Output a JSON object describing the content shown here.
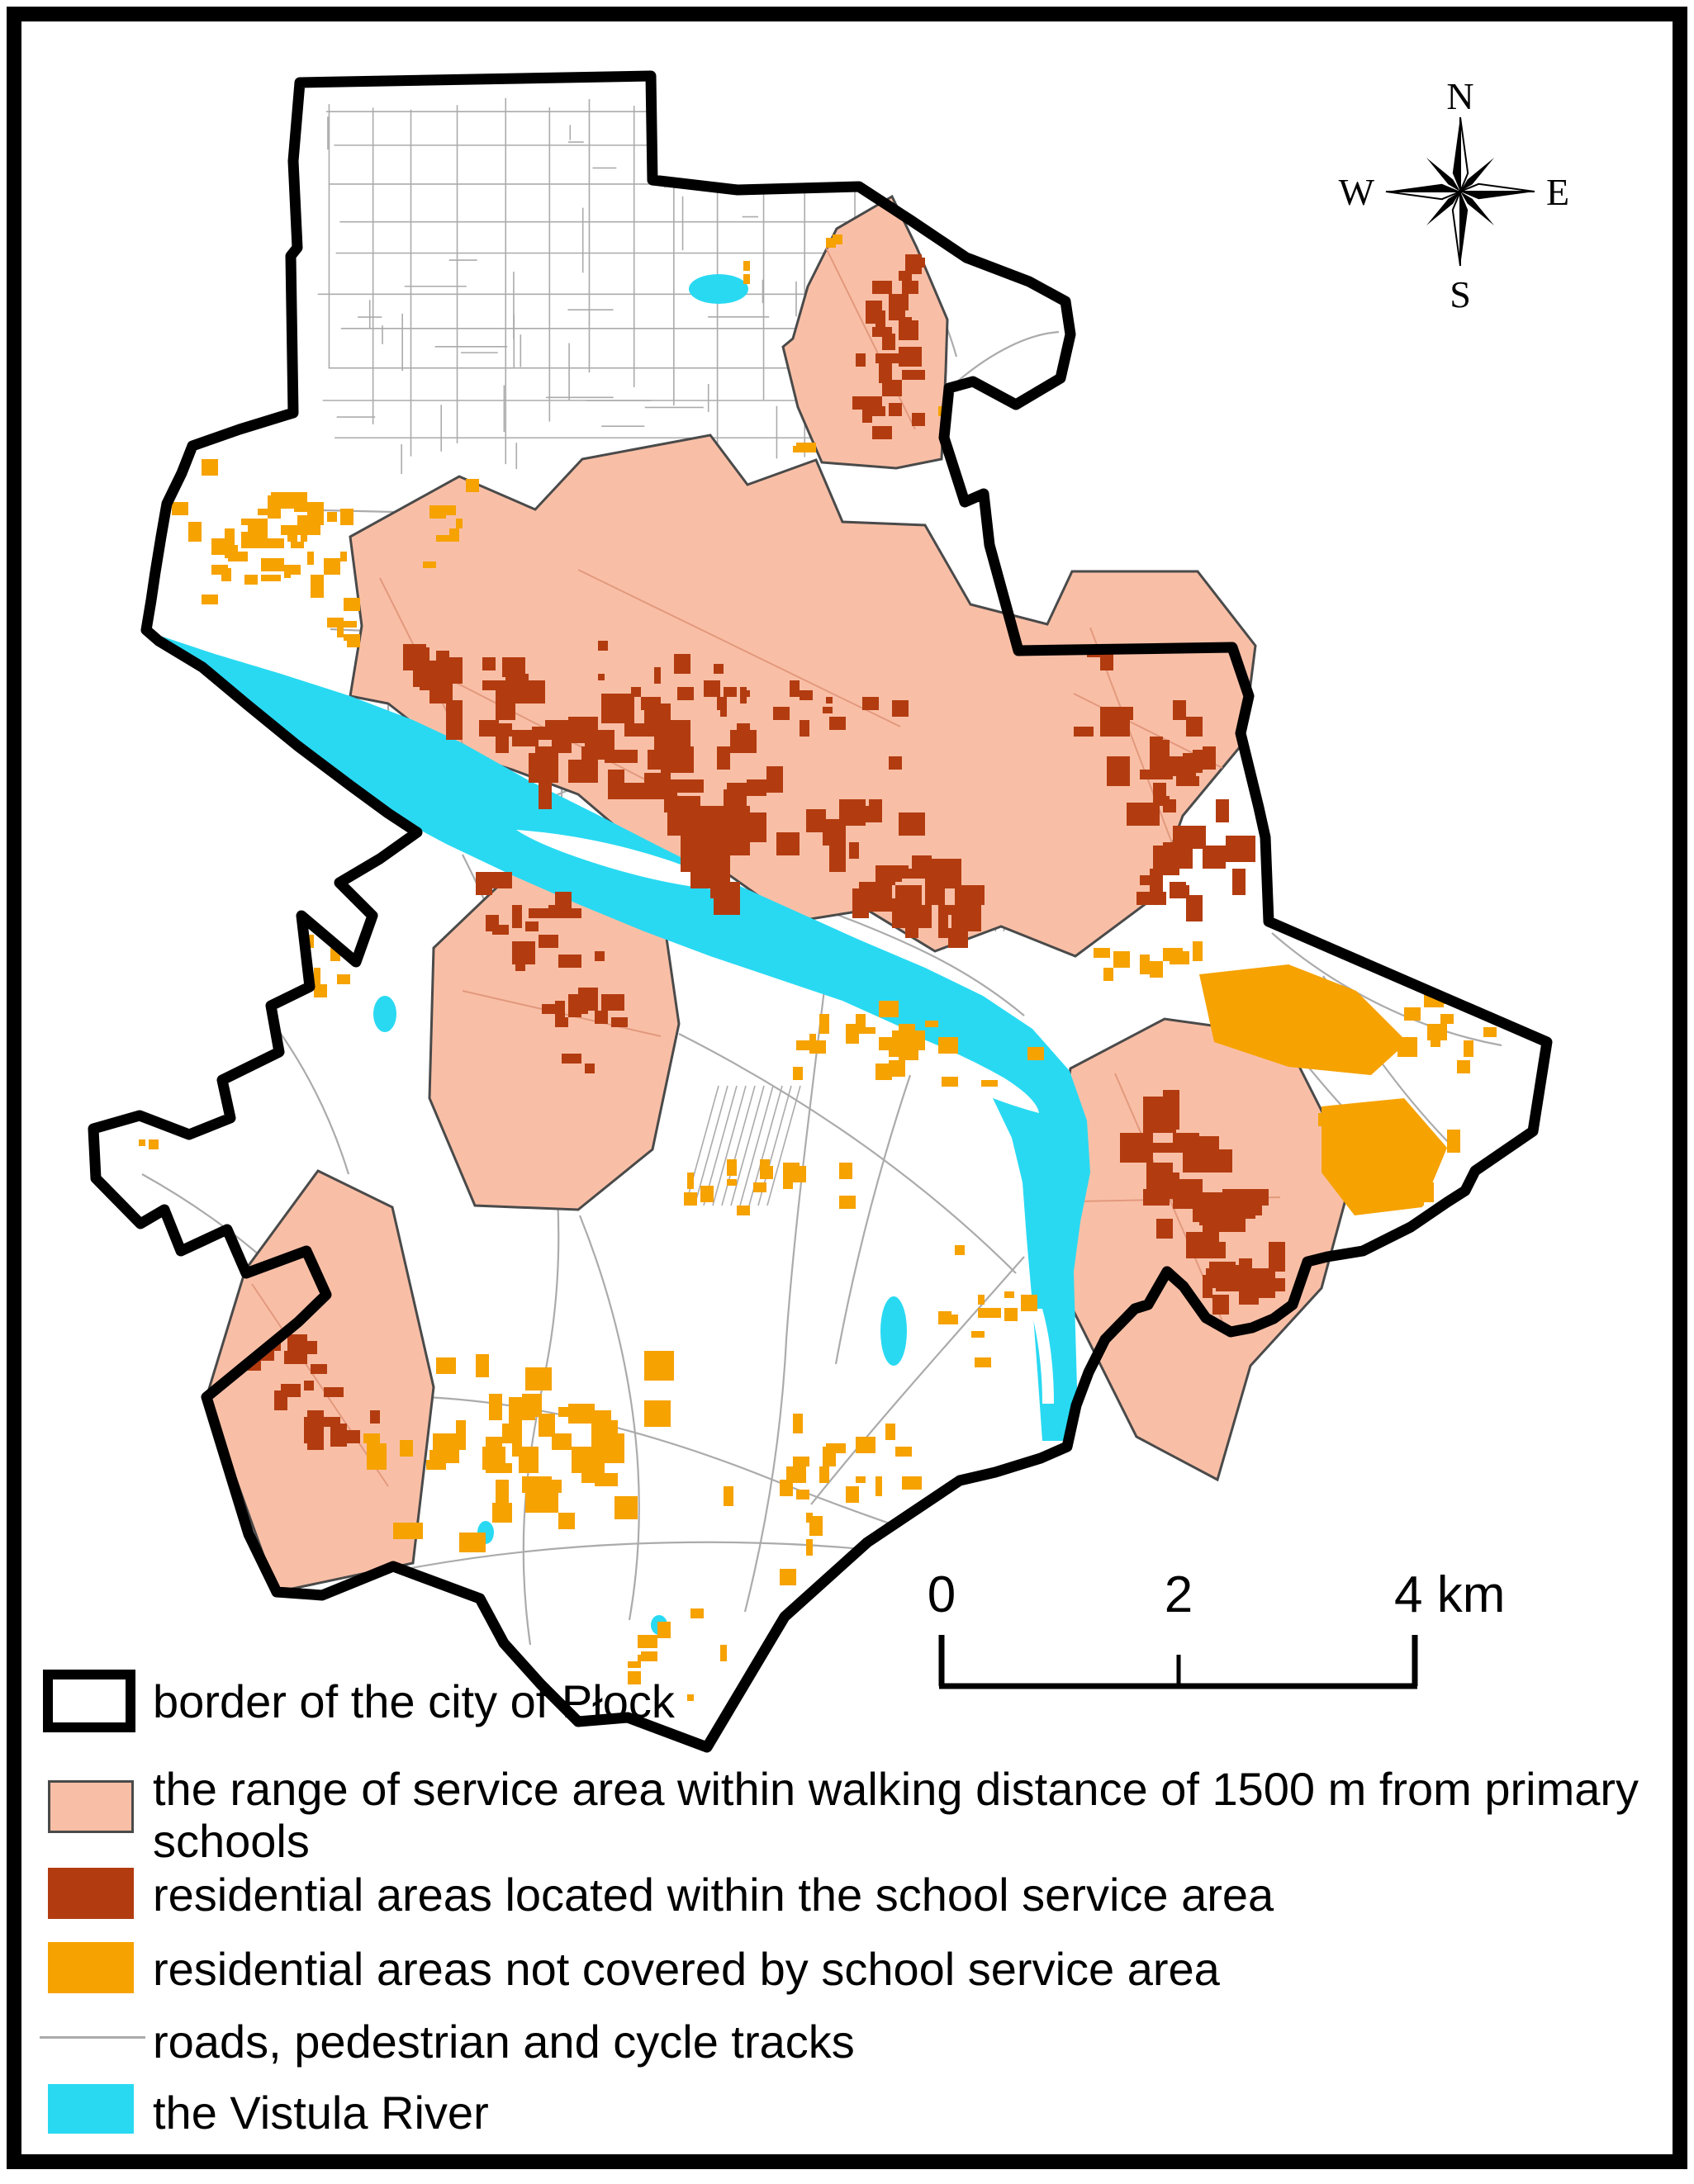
{
  "compass": {
    "north": "N",
    "east": "E",
    "south": "S",
    "west": "W"
  },
  "scale_bar": {
    "labels": [
      "0",
      "2",
      "4 km"
    ],
    "ticks_km": [
      0,
      2,
      4
    ]
  },
  "legend": {
    "items": [
      {
        "id": "city-border",
        "swatch": "outlined-rect",
        "label": "border of the city of Płock"
      },
      {
        "id": "service-area",
        "swatch": "filled-rect",
        "label": "the range of service area within walking distance of 1500 m from primary schools"
      },
      {
        "id": "residential-within",
        "swatch": "filled-rect",
        "label": "residential areas located within the school service area"
      },
      {
        "id": "residential-not-covered",
        "swatch": "filled-rect",
        "label": "residential areas not covered by school service area"
      },
      {
        "id": "roads",
        "swatch": "line",
        "label": "roads, pedestrian and cycle tracks"
      },
      {
        "id": "river",
        "swatch": "filled-rect",
        "label": "the Vistula River"
      }
    ]
  },
  "colors": {
    "city_border": "#000000",
    "service_area": "#F9BFA6",
    "service_area_outline": "#4A4A4A",
    "residential_within": "#B23C10",
    "residential_not_covered": "#F6A200",
    "roads": "#ABABAB",
    "river": "#29D9F2",
    "background": "#FFFFFF",
    "frame": "#000000"
  }
}
